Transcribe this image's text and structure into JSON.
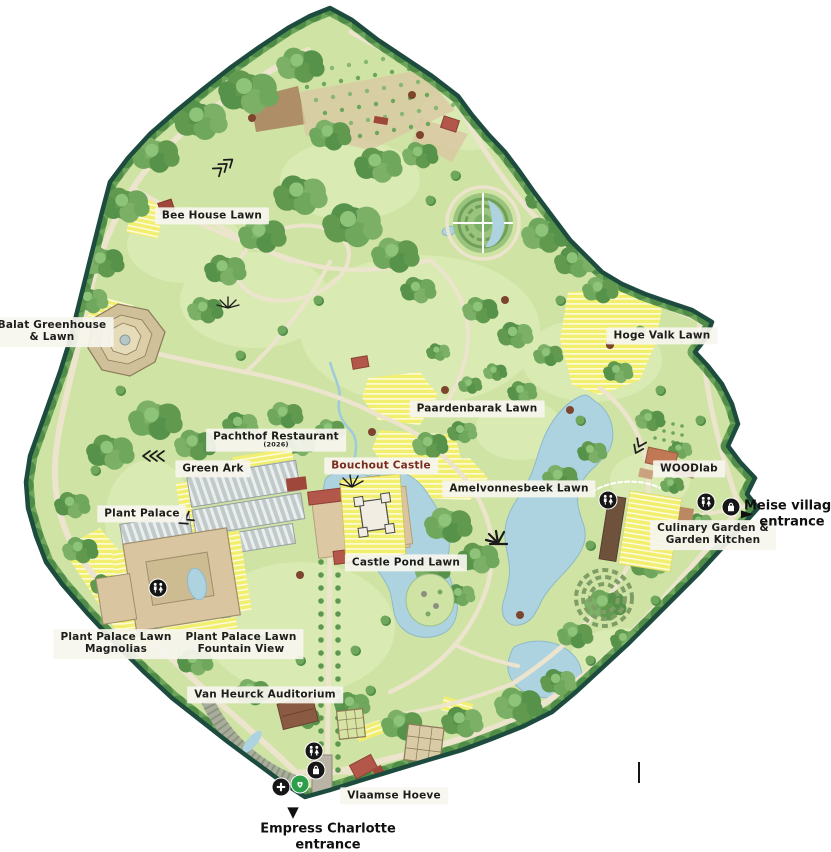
{
  "map": {
    "name": "botanic-garden-illustrated-map",
    "labels": [
      {
        "id": "bee-house-lawn",
        "text": "Bee House Lawn",
        "sub": ""
      },
      {
        "id": "balat-greenhouse-lawn",
        "text": "Balat Greenhouse",
        "sub": "& Lawn"
      },
      {
        "id": "hoge-valk-lawn",
        "text": "Hoge Valk Lawn",
        "sub": ""
      },
      {
        "id": "paardenbarak-lawn",
        "text": "Paardenbarak Lawn",
        "sub": ""
      },
      {
        "id": "pachthof-restaurant",
        "text": "Pachthof Restaurant",
        "sub": "(2026)"
      },
      {
        "id": "green-ark",
        "text": "Green Ark",
        "sub": ""
      },
      {
        "id": "bouchout-castle",
        "text": "Bouchout Castle",
        "sub": ""
      },
      {
        "id": "woodlab",
        "text": "WOODlab",
        "sub": ""
      },
      {
        "id": "amelvonnesbeek-lawn",
        "text": "Amelvonnesbeek Lawn",
        "sub": ""
      },
      {
        "id": "plant-palace",
        "text": "Plant Palace",
        "sub": ""
      },
      {
        "id": "culinary-garden-kitchen",
        "text": "Culinary Garden &",
        "sub": "Garden Kitchen"
      },
      {
        "id": "castle-pond-lawn",
        "text": "Castle Pond Lawn",
        "sub": ""
      },
      {
        "id": "plant-palace-lawn-magnolias",
        "text": "Plant Palace Lawn",
        "sub": "Magnolias"
      },
      {
        "id": "plant-palace-lawn-fountain-view",
        "text": "Plant Palace Lawn",
        "sub": "Fountain View"
      },
      {
        "id": "van-heurck-auditorium",
        "text": "Van Heurck Auditorium",
        "sub": ""
      },
      {
        "id": "vlaamse-hoeve",
        "text": "Vlaamse Hoeve",
        "sub": ""
      }
    ],
    "entrances": {
      "meise": {
        "line1": "Meise village",
        "line2": "entrance",
        "arrow": "►"
      },
      "empress": {
        "line1": "Empress Charlotte",
        "line2": "entrance",
        "arrow": "▼"
      }
    },
    "icons": {
      "toilets": "restroom figures",
      "shop": "shopping bag",
      "first_aid": "first-aid cross",
      "aed": "defibrillator heart"
    },
    "colors": {
      "border": "#1d4b3e",
      "base_green": "#cfe3a4",
      "woods_green": "#61994f",
      "lawn_yellow": "#f2ee6e",
      "water_blue": "#aed3e0",
      "path_cream": "#ece4cc",
      "label_bg": "#f6f5ee",
      "label_text": "#1d1d1b",
      "castle_label_text": "#7b2b1f",
      "icon_black": "#161616",
      "aed_green": "#2d9e4a",
      "roof_red": "#b2574a"
    }
  }
}
